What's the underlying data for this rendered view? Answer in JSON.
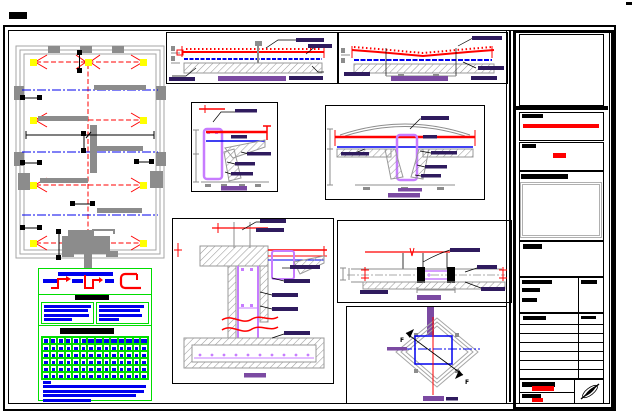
{
  "document": {
    "kind": "cad-structural-drawing-sheet",
    "note": "engineering drawing; all annotation text in source is below legible size and appears as solid bars"
  },
  "palette": {
    "paper": "#ffffff",
    "ink": "#000000",
    "gray": "#8c8c8c",
    "frame_gray": "#a6a6a6",
    "hatch_gray": "#9a9a9a",
    "silver": "#b0b0b0",
    "red": "#ff0000",
    "blue": "#0000ee",
    "yellow": "#ffff00",
    "green": "#00dd00",
    "violet": "#c77cff",
    "purple_title": "#7b4aa2",
    "purple_label": "#2f1b5e"
  },
  "plan": {
    "name": "foundation-plan",
    "grid_columns": 3,
    "grid_rows": 4,
    "column_marker_color": "#ffff00"
  },
  "details": {
    "slab_a": {
      "name": "slab-edge-section"
    },
    "slab_b": {
      "name": "slab-interior-section"
    },
    "edge_beam": {
      "name": "edge-beam-detail"
    },
    "mid_beam": {
      "name": "interior-beam-detail"
    },
    "foundation": {
      "name": "foundation-wall-detail"
    },
    "joint": {
      "name": "slab-joint-detail"
    },
    "diamond": {
      "name": "column-plan-detail",
      "section_label": "F"
    }
  },
  "legend": {
    "symbols": 3,
    "label_bars": 3,
    "has_title_bar": true
  },
  "notes": {
    "has_header_bar": true,
    "left_line_widths": [
      92,
      86,
      88,
      54
    ],
    "right_line_widths": [
      88,
      80,
      84,
      40
    ]
  },
  "schedule": {
    "has_header_bar": true,
    "columns": 14,
    "icon_cells": 6,
    "body_rows": 5,
    "paragraph_line_widths": [
      97,
      95,
      88,
      45
    ]
  },
  "title_block": {
    "sections": [
      "drawing-area",
      "client-block",
      "project-block",
      "stamp-block",
      "notes-block",
      "attribute-block",
      "revision-table",
      "signature-block"
    ],
    "revision_table": {
      "columns": 2,
      "rows": 6
    },
    "north_arrow_icon": "north-arrow"
  }
}
